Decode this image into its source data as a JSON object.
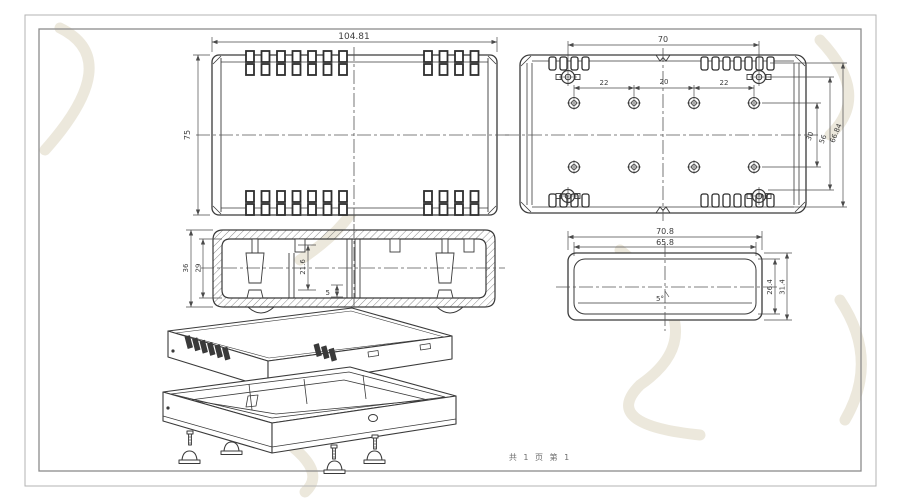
{
  "drawing": {
    "footer_text": "共 1 页  第 1",
    "views": {
      "top_view": {
        "dim_width": "104.81",
        "dim_height": "75"
      },
      "interior_view": {
        "dim_width": "70",
        "dim_pitch_left": "22",
        "dim_pitch_center": "20",
        "dim_pitch_right": "22",
        "dim_row_gap": "30",
        "dim_mid_span": "56",
        "dim_outer_span": "66.84"
      },
      "section_view": {
        "dim_outer_height": "36",
        "dim_inner_height": "29",
        "dim_boss_depth": "21.6",
        "dim_rib": "5"
      },
      "end_view": {
        "dim_outer_width": "70.8",
        "dim_inner_width": "65.8",
        "dim_inner_height": "26.4",
        "dim_outer_height": "31.4",
        "draft_angle": "5°"
      }
    },
    "colors": {
      "line": "#3a3a3a",
      "dimension": "#4a4a4a",
      "frame_outer": "#b3b3b3",
      "frame_inner": "#8c8c8c",
      "watermark": "#ece8dc"
    }
  }
}
